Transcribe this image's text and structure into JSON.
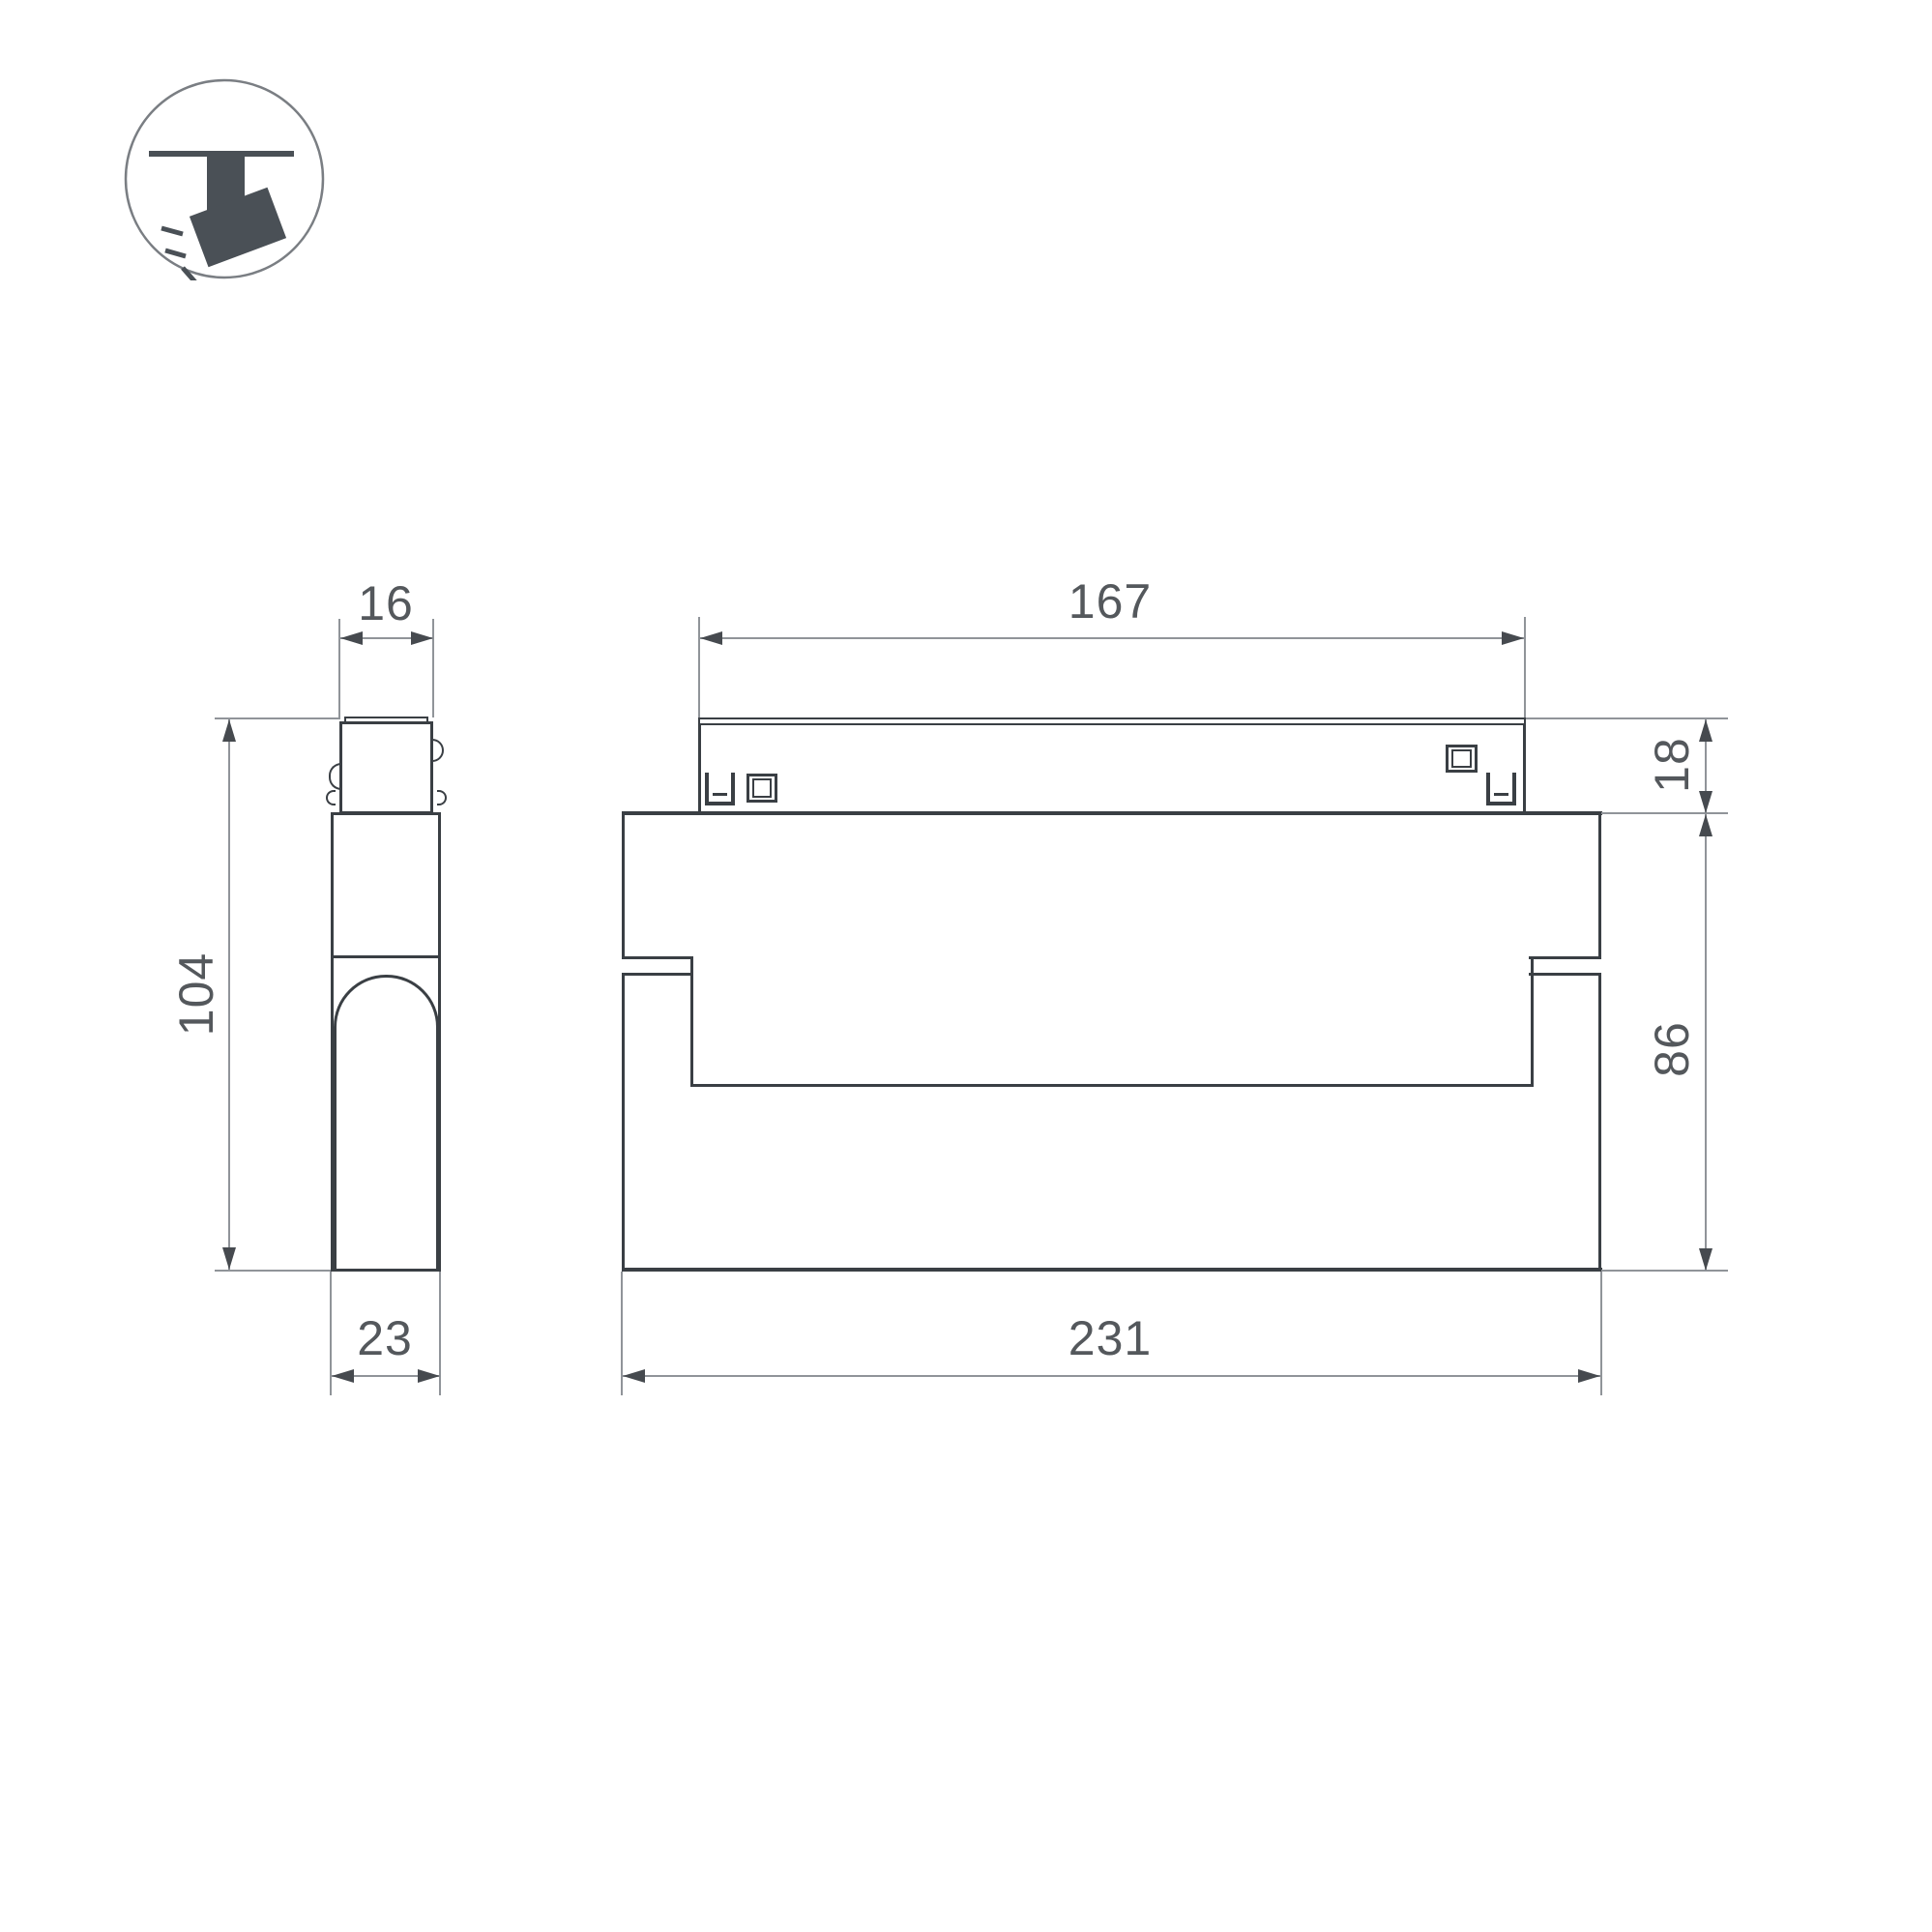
{
  "icon": {
    "name": "ceiling-track-spotlight",
    "color": "#4a5056",
    "ring_color": "#7a7e83"
  },
  "drawing": {
    "colors": {
      "outline": "#3a3f44",
      "dimension_lines": "#909499",
      "arrows": "#464a4f",
      "text": "#54585c",
      "background": "#ffffff"
    },
    "views": {
      "side": {
        "title": "side-view",
        "dims": {
          "top_width": "16",
          "height": "104",
          "depth": "23"
        }
      },
      "front": {
        "title": "front-view",
        "dims": {
          "track_width": "167",
          "track_height": "18",
          "body_height": "86",
          "body_width": "231"
        }
      }
    }
  }
}
